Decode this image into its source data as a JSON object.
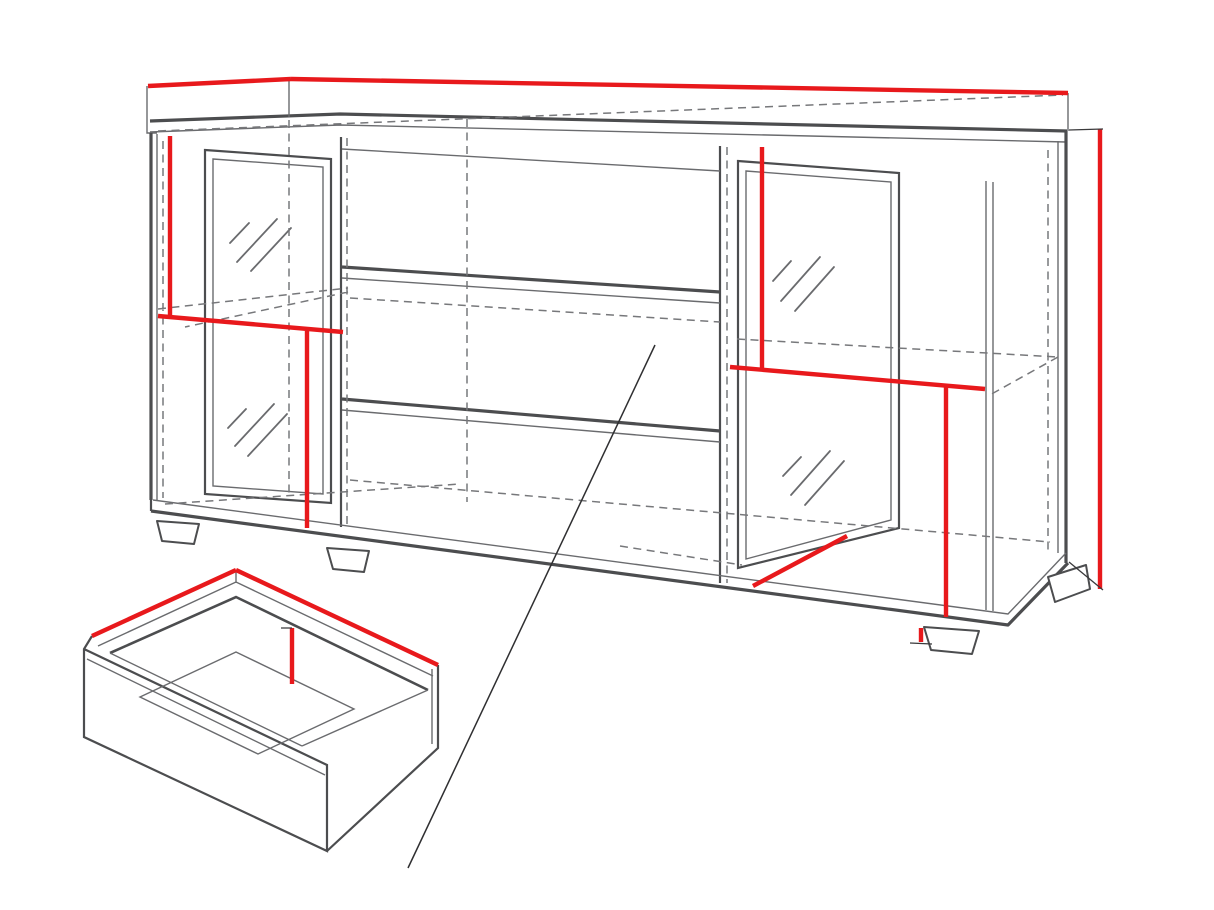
{
  "diagram": {
    "unit": "cm",
    "colors": {
      "accent": "#e8191c",
      "line": "#6a6b6e",
      "line_mid": "#77787b",
      "line_dark": "#4c4d4f",
      "ink": "#161616",
      "background": "#ffffff"
    },
    "dimensions": {
      "top_depth": {
        "value": "40",
        "unit": "cm"
      },
      "top_width": {
        "value": "150",
        "unit": "cm"
      },
      "overall_height": {
        "value": "70",
        "unit": "cm"
      },
      "left_upper_door_height": {
        "value": "32",
        "unit": "cm"
      },
      "left_shelf_width": {
        "value": "37",
        "unit": "cm"
      },
      "left_lower_door_height": {
        "value": "31",
        "unit": "cm"
      },
      "right_upper_door_height": {
        "value": "32",
        "unit": "cm"
      },
      "right_shelf_width": {
        "value": "37",
        "unit": "cm"
      },
      "right_lower_door_height": {
        "value": "31",
        "unit": "cm"
      },
      "right_door_bottom_width": {
        "value": "36",
        "unit": "cm"
      },
      "plinth_height": {
        "value": "2",
        "unit": "cm"
      },
      "drawer_depth": {
        "value": "33",
        "unit": "cm"
      },
      "drawer_width": {
        "value": "63",
        "unit": "cm"
      },
      "drawer_inner_height": {
        "value": "12",
        "unit": "cm"
      }
    }
  }
}
